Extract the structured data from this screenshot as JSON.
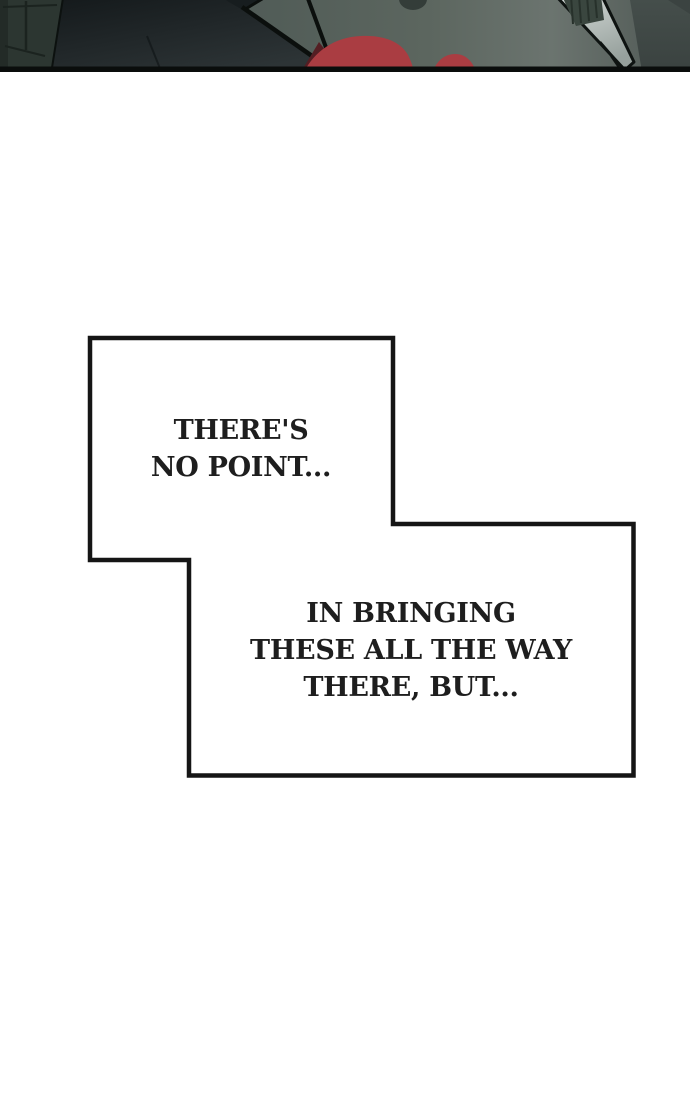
{
  "colors": {
    "page_bg": "#ffffff",
    "bubble_fill": "#ffffff",
    "bubble_border": "#151515",
    "dialogue_ink": "#1e1e1e",
    "panel_border": "#0a0d0c",
    "wall_mid": "#525d58",
    "wall_light": "#6b746f",
    "door_green": "#2c3631",
    "slab_dark": "#171d1f",
    "line_black": "#0b0f0d",
    "blood_red": "#aa3d42",
    "blood_dark": "#541e23",
    "blade_light": "#d4dad7",
    "right_dark": "#454e4b"
  },
  "speech_bubbles": [
    {
      "id": "bubble-1",
      "lines": [
        "THERE'S",
        "NO POINT..."
      ]
    },
    {
      "id": "bubble-2",
      "lines": [
        "IN BRINGING",
        "THESE ALL THE WAY",
        "THERE, BUT..."
      ]
    }
  ]
}
